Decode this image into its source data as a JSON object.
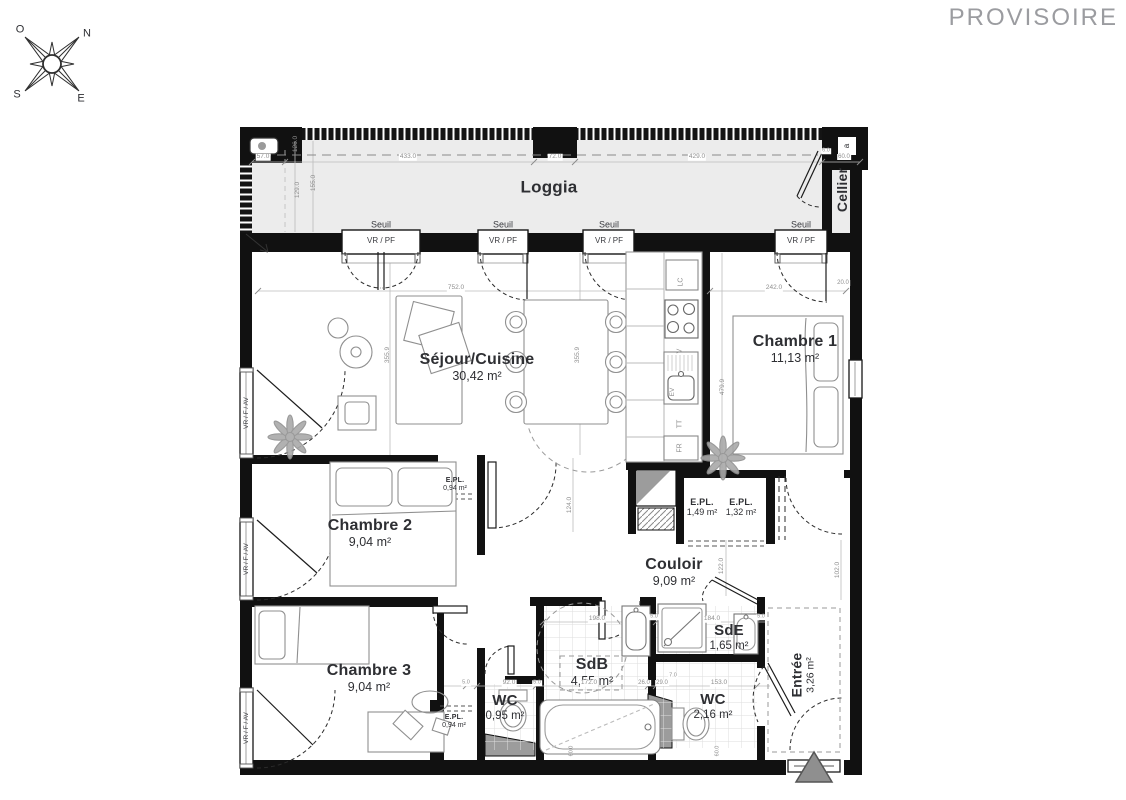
{
  "theme": {
    "wall": "#111111",
    "room_text": "#2e2f33",
    "dim": "#8e8e8e",
    "window_text": "#3a3b40",
    "provisoire": "#9b9ca0",
    "loggia_fill": "#ececec",
    "fixture_stroke": "#8f8f8f",
    "marker_fill": "#8f8f8f"
  },
  "header": {
    "status": "PROVISOIRE"
  },
  "plan": {
    "rooms": [
      {
        "id": "loggia",
        "label": "Loggia",
        "area": null,
        "x": 549,
        "y": 187,
        "fs": 17,
        "afs": 13
      },
      {
        "id": "cellier",
        "label": "Cellier",
        "area": null,
        "x": 843,
        "y": 190,
        "fs": 14,
        "afs": 11,
        "rot": -90
      },
      {
        "id": "sejour-cuisine",
        "label": "Séjour/Cuisine",
        "area": "30,42 m²",
        "x": 477,
        "y": 367,
        "fs": 16,
        "afs": 12.5
      },
      {
        "id": "chambre-1",
        "label": "Chambre 1",
        "area": "11,13 m²",
        "x": 795,
        "y": 349,
        "fs": 16,
        "afs": 12.5
      },
      {
        "id": "chambre-2",
        "label": "Chambre 2",
        "area": "9,04 m²",
        "x": 370,
        "y": 533,
        "fs": 16,
        "afs": 12.5
      },
      {
        "id": "chambre-3",
        "label": "Chambre 3",
        "area": "9,04 m²",
        "x": 369,
        "y": 678,
        "fs": 16,
        "afs": 12.5
      },
      {
        "id": "couloir",
        "label": "Couloir",
        "area": "9,09 m²",
        "x": 674,
        "y": 572,
        "fs": 16,
        "afs": 12.5
      },
      {
        "id": "sdb",
        "label": "SdB",
        "area": "4,55 m²",
        "x": 592,
        "y": 672,
        "fs": 16,
        "afs": 12.5
      },
      {
        "id": "sde",
        "label": "SdE",
        "area": "1,65 m²",
        "x": 729,
        "y": 638,
        "fs": 15,
        "afs": 11.5
      },
      {
        "id": "wc-1",
        "label": "WC",
        "area": "0,95 m²",
        "x": 505,
        "y": 708,
        "fs": 15,
        "afs": 11.5
      },
      {
        "id": "wc-2",
        "label": "WC",
        "area": "2,16 m²",
        "x": 713,
        "y": 707,
        "fs": 15,
        "afs": 11.5
      },
      {
        "id": "entree",
        "label": "Entrée",
        "area": "3,26 m²",
        "x": 803,
        "y": 675,
        "fs": 14,
        "afs": 10.5,
        "rot": -90
      },
      {
        "id": "epl-chambre2",
        "label": "E.PL.",
        "area": "0,94 m²",
        "x": 455,
        "y": 485,
        "fs": 7,
        "afs": 7
      },
      {
        "id": "epl-couloir-1",
        "label": "E.PL.",
        "area": "1,49 m²",
        "x": 702,
        "y": 507,
        "fs": 9,
        "afs": 9
      },
      {
        "id": "epl-couloir-2",
        "label": "E.PL.",
        "area": "1,32 m²",
        "x": 741,
        "y": 507,
        "fs": 9,
        "afs": 9
      },
      {
        "id": "epl-chambre3",
        "label": "E.PL.",
        "area": "0,94 m²",
        "x": 454,
        "y": 722,
        "fs": 7,
        "afs": 7
      }
    ],
    "annotations": [
      {
        "n": "compass-letter-o",
        "t": "O",
        "x": 20,
        "y": 30,
        "fs": 11,
        "c": "room_text"
      },
      {
        "n": "compass-letter-n",
        "t": "N",
        "x": 87,
        "y": 34,
        "fs": 11,
        "c": "room_text"
      },
      {
        "n": "compass-letter-s",
        "t": "S",
        "x": 17,
        "y": 95,
        "fs": 11,
        "c": "room_text"
      },
      {
        "n": "compass-letter-e",
        "t": "E",
        "x": 81,
        "y": 99,
        "fs": 11,
        "c": "room_text"
      },
      {
        "n": "detail-a",
        "t": "a",
        "x": 847,
        "y": 146,
        "fs": 8,
        "rot": -90,
        "c": "room_text"
      },
      {
        "n": "seuil-1",
        "t": "Seuil",
        "x": 381,
        "y": 225,
        "fs": 9,
        "c": "window_text"
      },
      {
        "n": "seuil-2",
        "t": "Seuil",
        "x": 503,
        "y": 225,
        "fs": 9,
        "c": "window_text"
      },
      {
        "n": "seuil-3",
        "t": "Seuil",
        "x": 609,
        "y": 225,
        "fs": 9,
        "c": "window_text"
      },
      {
        "n": "seuil-4",
        "t": "Seuil",
        "x": 801,
        "y": 225,
        "fs": 9,
        "c": "window_text"
      },
      {
        "n": "vrpf-1",
        "t": "VR / PF",
        "x": 381,
        "y": 241,
        "fs": 8,
        "c": "window_text"
      },
      {
        "n": "vrpf-2",
        "t": "VR / PF",
        "x": 503,
        "y": 241,
        "fs": 8,
        "c": "window_text"
      },
      {
        "n": "vrpf-3",
        "t": "VR / PF",
        "x": 609,
        "y": 241,
        "fs": 8,
        "c": "window_text"
      },
      {
        "n": "vrpf-4",
        "t": "VR / PF",
        "x": 801,
        "y": 241,
        "fs": 8,
        "c": "window_text"
      },
      {
        "n": "vrfav-1",
        "t": "VR / F / AV",
        "x": 247,
        "y": 413,
        "fs": 6.5,
        "rot": -90,
        "c": "window_text"
      },
      {
        "n": "vrfav-2",
        "t": "VR / F / AV",
        "x": 247,
        "y": 559,
        "fs": 6.5,
        "rot": -90,
        "c": "window_text"
      },
      {
        "n": "vrfav-3",
        "t": "VR / F / AV",
        "x": 247,
        "y": 728,
        "fs": 6.5,
        "rot": -90,
        "c": "window_text"
      },
      {
        "n": "kitchen-lc",
        "t": "LC",
        "x": 681,
        "y": 282,
        "fs": 7,
        "rot": -90
      },
      {
        "n": "kitchen-v",
        "t": "V",
        "x": 680,
        "y": 351,
        "fs": 7,
        "rot": -90
      },
      {
        "n": "kitchen-ev",
        "t": "EV",
        "x": 673,
        "y": 392,
        "fs": 6.5,
        "rot": -90
      },
      {
        "n": "kitchen-tt",
        "t": "TT",
        "x": 680,
        "y": 424,
        "fs": 7,
        "rot": -90
      },
      {
        "n": "kitchen-fr",
        "t": "FR",
        "x": 680,
        "y": 448,
        "fs": 7,
        "rot": -90
      },
      {
        "n": "dim-57",
        "t": "57.0",
        "x": 263,
        "y": 157,
        "fs": 6.5,
        "bg": true
      },
      {
        "n": "dim-433",
        "t": "433.0",
        "x": 408,
        "y": 157,
        "fs": 6.5,
        "bg": true
      },
      {
        "n": "dim-72",
        "t": "72.0",
        "x": 555,
        "y": 157,
        "fs": 6.5,
        "bg": true
      },
      {
        "n": "dim-429",
        "t": "429.0",
        "x": 697,
        "y": 157,
        "fs": 6.5,
        "bg": true
      },
      {
        "n": "dim-6",
        "t": "6.0",
        "x": 826,
        "y": 151,
        "fs": 5.5,
        "bg": true
      },
      {
        "n": "dim-60a",
        "t": "60.0",
        "x": 844,
        "y": 157,
        "fs": 6,
        "bg": true
      },
      {
        "n": "dim-126",
        "t": "126.0",
        "x": 296,
        "y": 144,
        "fs": 6.5,
        "rot": -90
      },
      {
        "n": "dim-129",
        "t": "129.0",
        "x": 298,
        "y": 190,
        "fs": 6.5,
        "rot": -90
      },
      {
        "n": "dim-155",
        "t": "155.0",
        "x": 314,
        "y": 183,
        "fs": 6.5,
        "rot": -90
      },
      {
        "n": "dim-752",
        "t": "752.0",
        "x": 456,
        "y": 288,
        "fs": 6.5,
        "bg": true
      },
      {
        "n": "dim-242",
        "t": "242.0",
        "x": 774,
        "y": 288,
        "fs": 6.5,
        "bg": true
      },
      {
        "n": "dim-20",
        "t": "20.0",
        "x": 843,
        "y": 283,
        "fs": 6,
        "bg": true
      },
      {
        "n": "dim-3559a",
        "t": "355.9",
        "x": 388,
        "y": 355,
        "fs": 6.5,
        "rot": -90
      },
      {
        "n": "dim-3559b",
        "t": "355.9",
        "x": 578,
        "y": 355,
        "fs": 6.5,
        "rot": -90
      },
      {
        "n": "dim-4799",
        "t": "479.9",
        "x": 723,
        "y": 387,
        "fs": 6.5,
        "rot": -90
      },
      {
        "n": "dim-124",
        "t": "124.0",
        "x": 570,
        "y": 505,
        "fs": 6.5,
        "rot": -90
      },
      {
        "n": "dim-122",
        "t": "122.0",
        "x": 722,
        "y": 566,
        "fs": 6.5,
        "rot": -90
      },
      {
        "n": "dim-102",
        "t": "102.0",
        "x": 838,
        "y": 570,
        "fs": 6.5,
        "rot": -90
      },
      {
        "n": "dim-198",
        "t": "198.0",
        "x": 597,
        "y": 619,
        "fs": 6.5,
        "bg": true
      },
      {
        "n": "dim-184",
        "t": "184.0",
        "x": 712,
        "y": 619,
        "fs": 6.5,
        "bg": true
      },
      {
        "n": "dim-5a",
        "t": "5.0",
        "x": 654,
        "y": 617,
        "fs": 5.5,
        "bg": true
      },
      {
        "n": "dim-5b",
        "t": "5.0",
        "x": 761,
        "y": 617,
        "fs": 5.5,
        "bg": true
      },
      {
        "n": "dim-172",
        "t": "172.0",
        "x": 589,
        "y": 683,
        "fs": 6.5,
        "bg": true
      },
      {
        "n": "dim-26",
        "t": "26.0",
        "x": 644,
        "y": 683,
        "fs": 6,
        "bg": true
      },
      {
        "n": "dim-29",
        "t": "29.0",
        "x": 662,
        "y": 683,
        "fs": 6,
        "bg": true
      },
      {
        "n": "dim-7",
        "t": "7.0",
        "x": 673,
        "y": 676,
        "fs": 5.5,
        "bg": true
      },
      {
        "n": "dim-153",
        "t": "153.0",
        "x": 719,
        "y": 683,
        "fs": 6.5,
        "bg": true
      },
      {
        "n": "dim-92",
        "t": "92.0",
        "x": 509,
        "y": 683,
        "fs": 6.5,
        "bg": true
      },
      {
        "n": "dim-5c",
        "t": "5.0",
        "x": 466,
        "y": 683,
        "fs": 5.5,
        "bg": true
      },
      {
        "n": "dim-5d",
        "t": "5.0",
        "x": 537,
        "y": 683,
        "fs": 5.5,
        "bg": true
      },
      {
        "n": "dim-60b",
        "t": "60.0",
        "x": 572,
        "y": 751,
        "fs": 5.5,
        "rot": -90
      },
      {
        "n": "dim-60c",
        "t": "60.0",
        "x": 718,
        "y": 751,
        "fs": 5.5,
        "rot": -90
      }
    ]
  }
}
